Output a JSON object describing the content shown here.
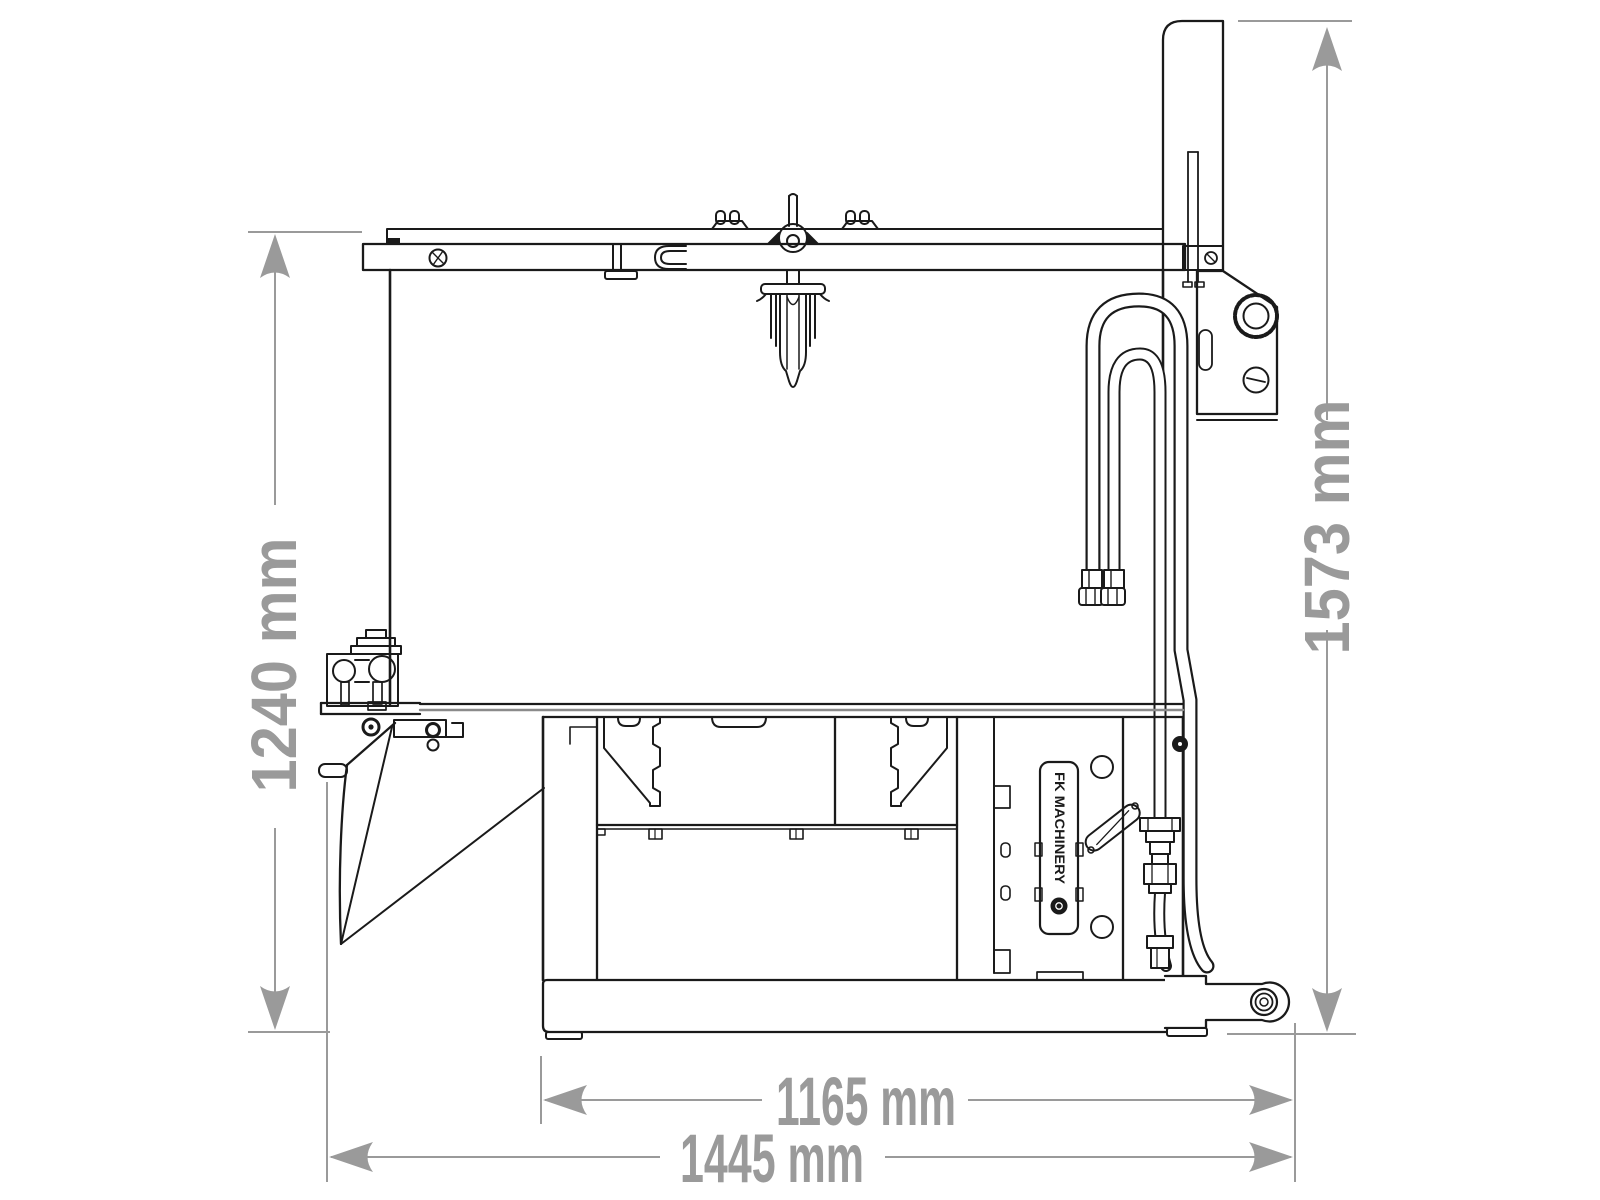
{
  "figure": {
    "type": "technical-dimension-drawing",
    "subject": "side view of an industrial mixer / bucket attachment with hydraulic hoses, hinged chute and tow hitch",
    "colors": {
      "background": "#ffffff",
      "line": "#1a1a1a",
      "dimension": "#9a9a9a"
    }
  },
  "dimensions": {
    "left_height": {
      "label": "1240 mm",
      "value": 1240,
      "unit": "mm"
    },
    "right_height": {
      "label": "1573 mm",
      "value": 1573,
      "unit": "mm"
    },
    "base_inner_width": {
      "label": "1165 mm",
      "value": 1165,
      "unit": "mm"
    },
    "base_overall_width": {
      "label": "1445 mm",
      "value": 1445,
      "unit": "mm"
    }
  },
  "machine": {
    "brand_plate_text": "FK MACHINERY"
  }
}
